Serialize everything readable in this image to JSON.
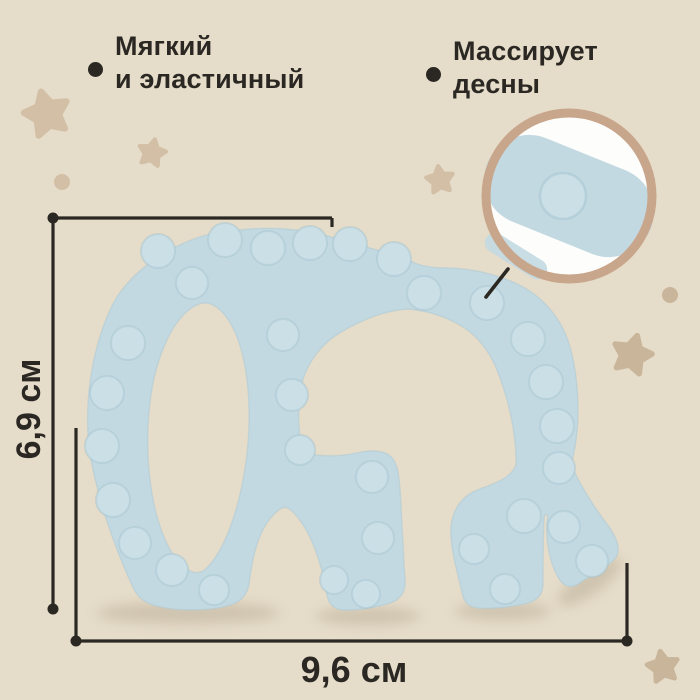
{
  "product_annotations": {
    "feature_1": {
      "line1": "Мягкий",
      "line2": "и эластичный"
    },
    "feature_2": {
      "line1": "Массирует",
      "line2": "десны"
    }
  },
  "dimensions": {
    "height_label": "6,9 см",
    "width_label": "9,6 см"
  },
  "colors": {
    "background": "#e5dcc9",
    "elephant": "#c3d9e2",
    "elephant_edge": "#b0cbd6",
    "bump": "#cbdfe7",
    "bump_edge": "#a4c3cf",
    "star": "#d2bfa6",
    "star_dark": "#c9b59a",
    "shadow": "#8d7c63",
    "line": "#2b2823",
    "text": "#2b2823",
    "magnifier_ring": "#c8a68c",
    "magnifier_bg": "#fdfdfc"
  }
}
